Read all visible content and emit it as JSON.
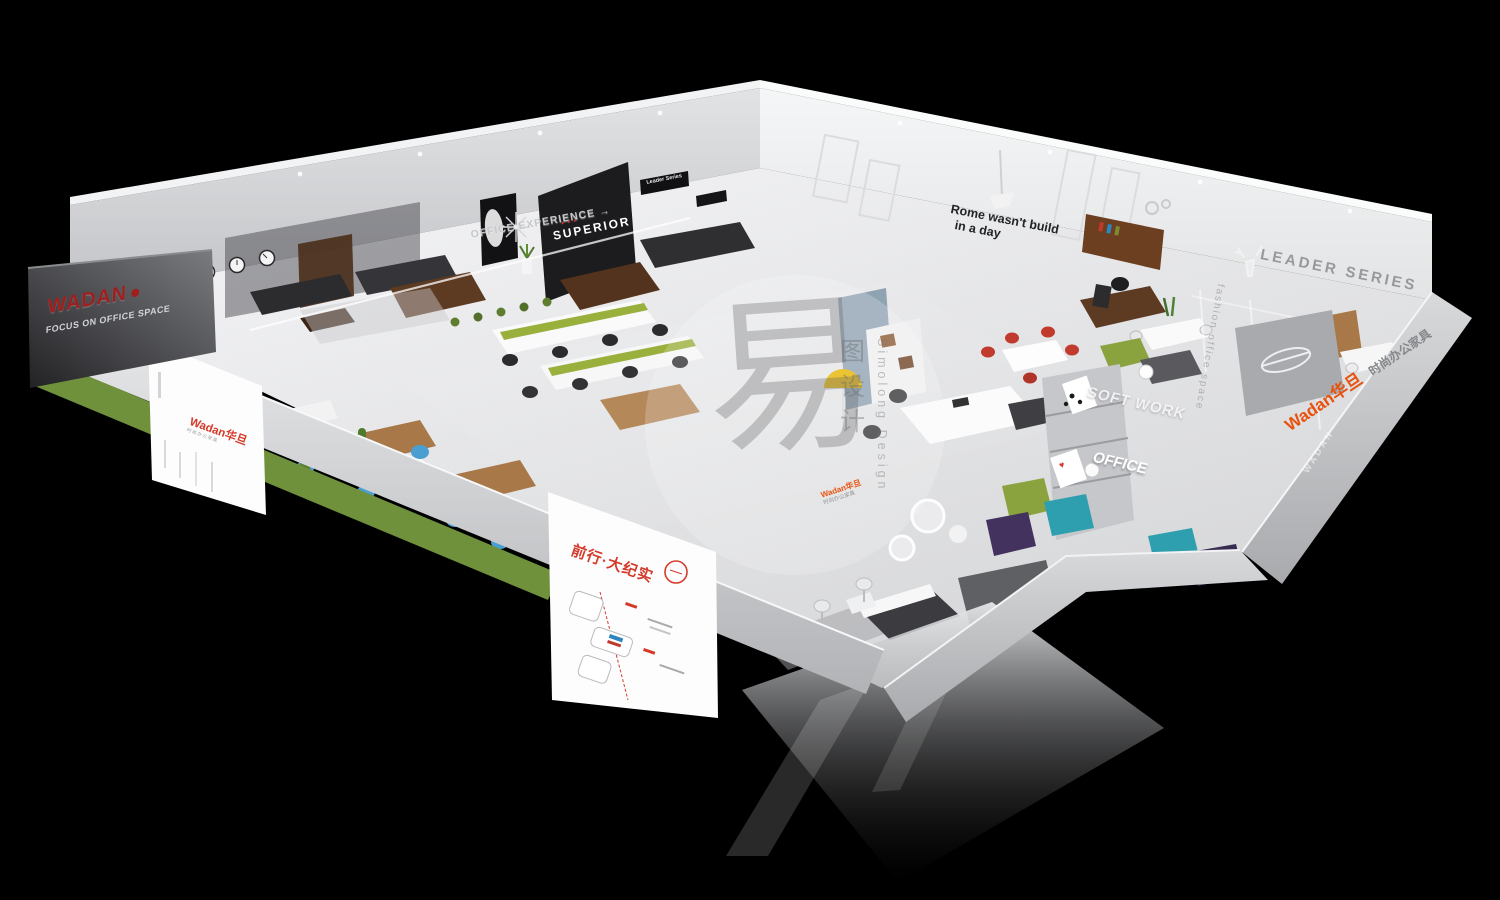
{
  "scene": {
    "background": "#000000"
  },
  "branding": {
    "exterior_logo": "WADAN",
    "exterior_tagline": "FOCUS ON OFFICE SPACE",
    "brand_cn": "Wadan华旦",
    "brand_subtitle_cn": "时尚办公家具"
  },
  "wall_signs": {
    "superior": "SUPERIOR",
    "leader_series_plaque": "Leader Series",
    "rome_line1": "Rome wasn't build",
    "rome_line2": "in a day",
    "leader_series_wall": "LEADER SERIES",
    "office_experience": "OFFICE EXPERIENCE"
  },
  "glass_texts": {
    "soft_work": "SOFT WORK",
    "office": "OFFICE",
    "fashion": "fashion office space",
    "wadan_column": "WADAN"
  },
  "posters": {
    "left_lightbox_brand": "Wadan华旦",
    "left_lightbox_subtitle": "时尚办公家具",
    "front_lightbox_title": "前行·大纪实"
  },
  "watermark": {
    "glyph": "易",
    "cn_vertical": "图设计",
    "en_vertical": "Simolong Design"
  },
  "icons": {
    "stars": "★★★",
    "arrow": "→",
    "heart": "♥"
  },
  "colors": {
    "brand_red": "#9e1f1e",
    "accent_orange": "#e8520f",
    "poster_red": "#d43a2a",
    "grass_green": "#6f913b",
    "olive_sofa": "#8aa33e",
    "teal_sofa": "#2e9fae",
    "purple_sofa": "#43315e",
    "blue_chair": "#4a9fd0",
    "lamp_yellow": "#e6b400",
    "wood_dark": "#5d3a22",
    "wood_light": "#a87848"
  }
}
